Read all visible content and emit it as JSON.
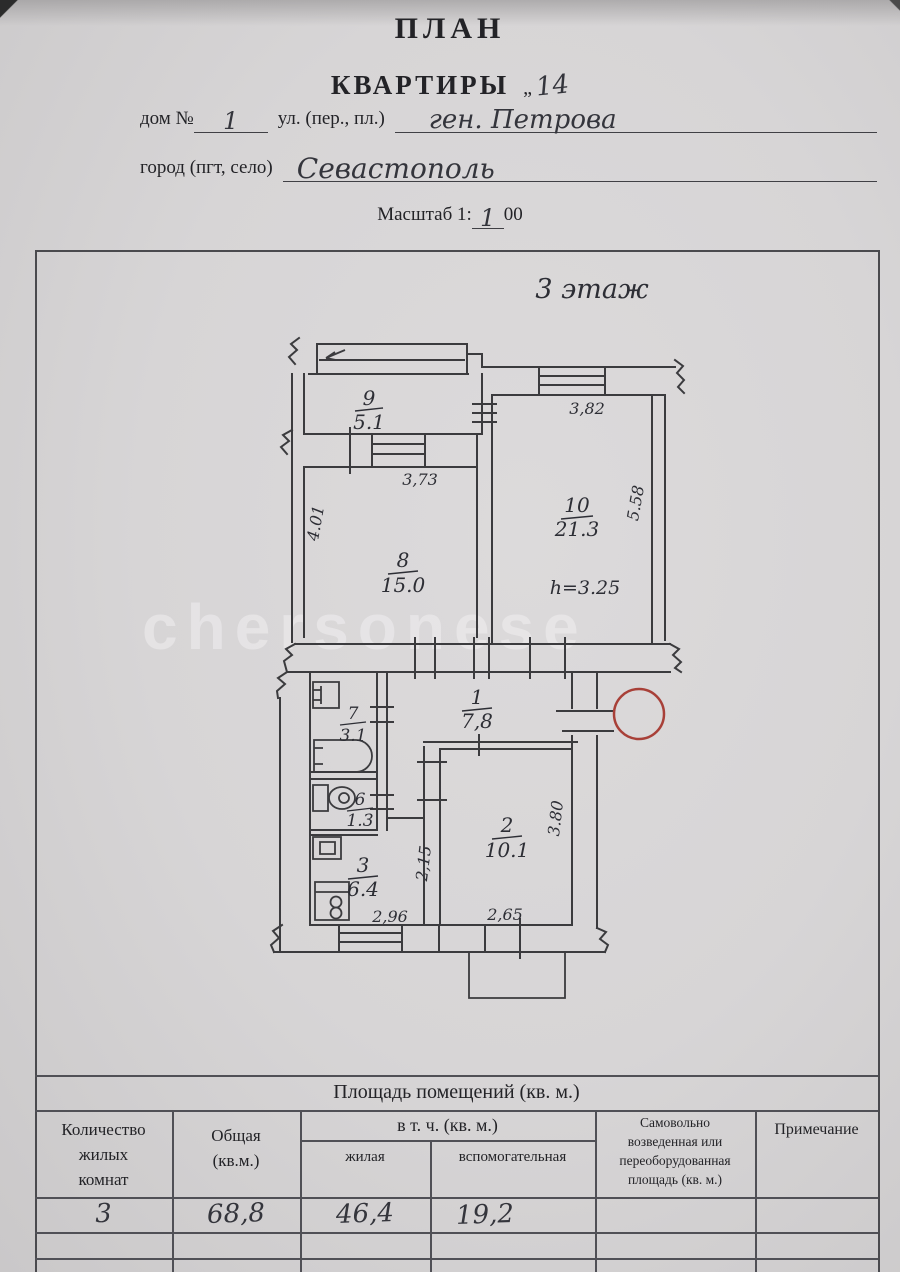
{
  "header": {
    "title": "ПЛАН",
    "subtitle": "КВАРТИРЫ",
    "apt_mark": "„",
    "apt_no": "14",
    "house_label": "дом №",
    "house_no": "1",
    "street_label": "ул. (пер., пл.)",
    "street_value": "ген. Петрова",
    "city_label": "город (пгт, село)",
    "city_value": "Севастополь",
    "scale_label": "Масштаб 1:",
    "scale_written": "1",
    "scale_tail": "00"
  },
  "plan": {
    "floor_label": "3 этаж",
    "watermark": "chersonese",
    "room_height": "h=3.25",
    "rooms": [
      {
        "number": "9",
        "area": "5.1"
      },
      {
        "number": "10",
        "area": "21.3"
      },
      {
        "number": "8",
        "area": "15.0"
      },
      {
        "number": "1",
        "area": "7,8"
      },
      {
        "number": "7",
        "area": "3.1"
      },
      {
        "number": "6",
        "area": "1.3"
      },
      {
        "number": "3",
        "area": "6.4"
      },
      {
        "number": "2",
        "area": "10.1"
      }
    ],
    "dims": {
      "top": "3,82",
      "right": "5.58",
      "room8_top": "3,73",
      "room8_left": "4.01",
      "corridor": "2,15",
      "room2_right": "3.80",
      "bottom_left": "2,96",
      "bottom_right": "2,65"
    }
  },
  "table": {
    "title": "Площадь помещений (кв. м.)",
    "col_rooms": [
      "Количество",
      "жилых",
      "комнат"
    ],
    "col_total": [
      "Общая",
      "(кв.м.)"
    ],
    "col_incl": "в т. ч. (кв. м.)",
    "col_living": "жилая",
    "col_aux": "вспомогательная",
    "col_unauth": [
      "Самовольно",
      "возведенная или",
      "переоборудованная",
      "площадь (кв. м.)"
    ],
    "col_note": "Примечание",
    "row": {
      "rooms": "3",
      "total": "68,8",
      "living": "46,4",
      "aux": "19,2"
    }
  }
}
